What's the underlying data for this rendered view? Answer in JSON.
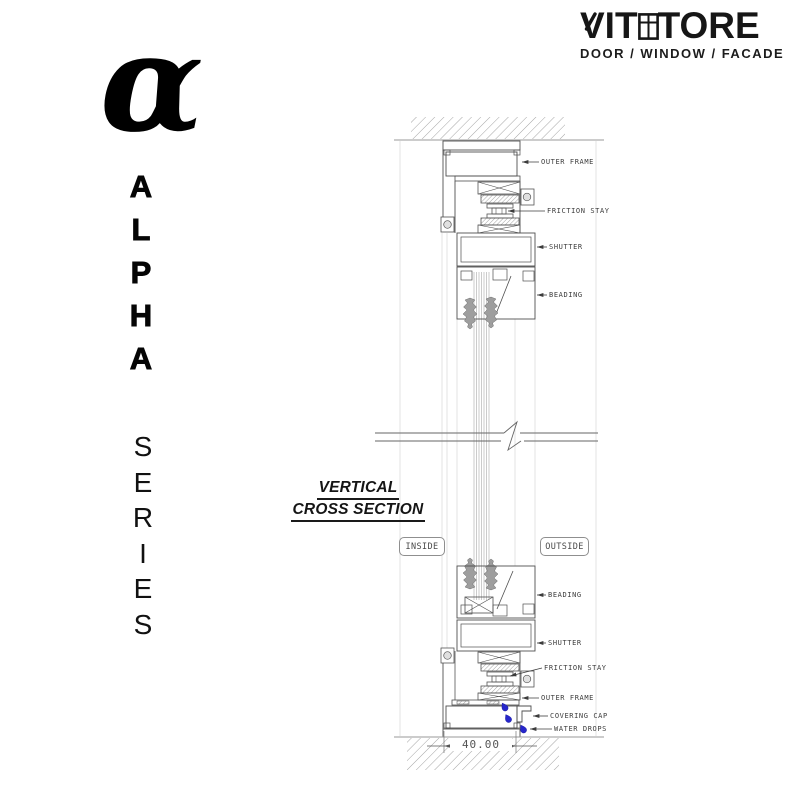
{
  "brand": {
    "name_prefix": "VIT",
    "name_suffix": "TORE",
    "tagline": "DOOR / WINDOW / FACADE"
  },
  "series": {
    "alpha_symbol": "α",
    "alpha_letters": [
      "A",
      "L",
      "P",
      "H",
      "A"
    ],
    "series_letters": [
      "S",
      "E",
      "R",
      "I",
      "E",
      "S"
    ],
    "name": "ALPHA SERIES"
  },
  "drawing": {
    "title_line1": "VERTICAL",
    "title_line2": "CROSS SECTION",
    "inside_label": "INSIDE",
    "outside_label": "OUTSIDE",
    "dimension_label": "40.00",
    "callouts_top": [
      "OUTER FRAME",
      "FRICTION STAY",
      "SHUTTER",
      "BEADING"
    ],
    "callouts_bottom": [
      "BEADING",
      "SHUTTER",
      "FRICTION STAY",
      "OUTER FRAME",
      "COVERING CAP",
      "WATER DROPS"
    ],
    "colors": {
      "line": "#4f4f4f",
      "hatch": "#9a9a9a",
      "gasket": "#9e9e9e",
      "water_drop": "#2626cb",
      "label_text": "#3c3c3c"
    }
  }
}
